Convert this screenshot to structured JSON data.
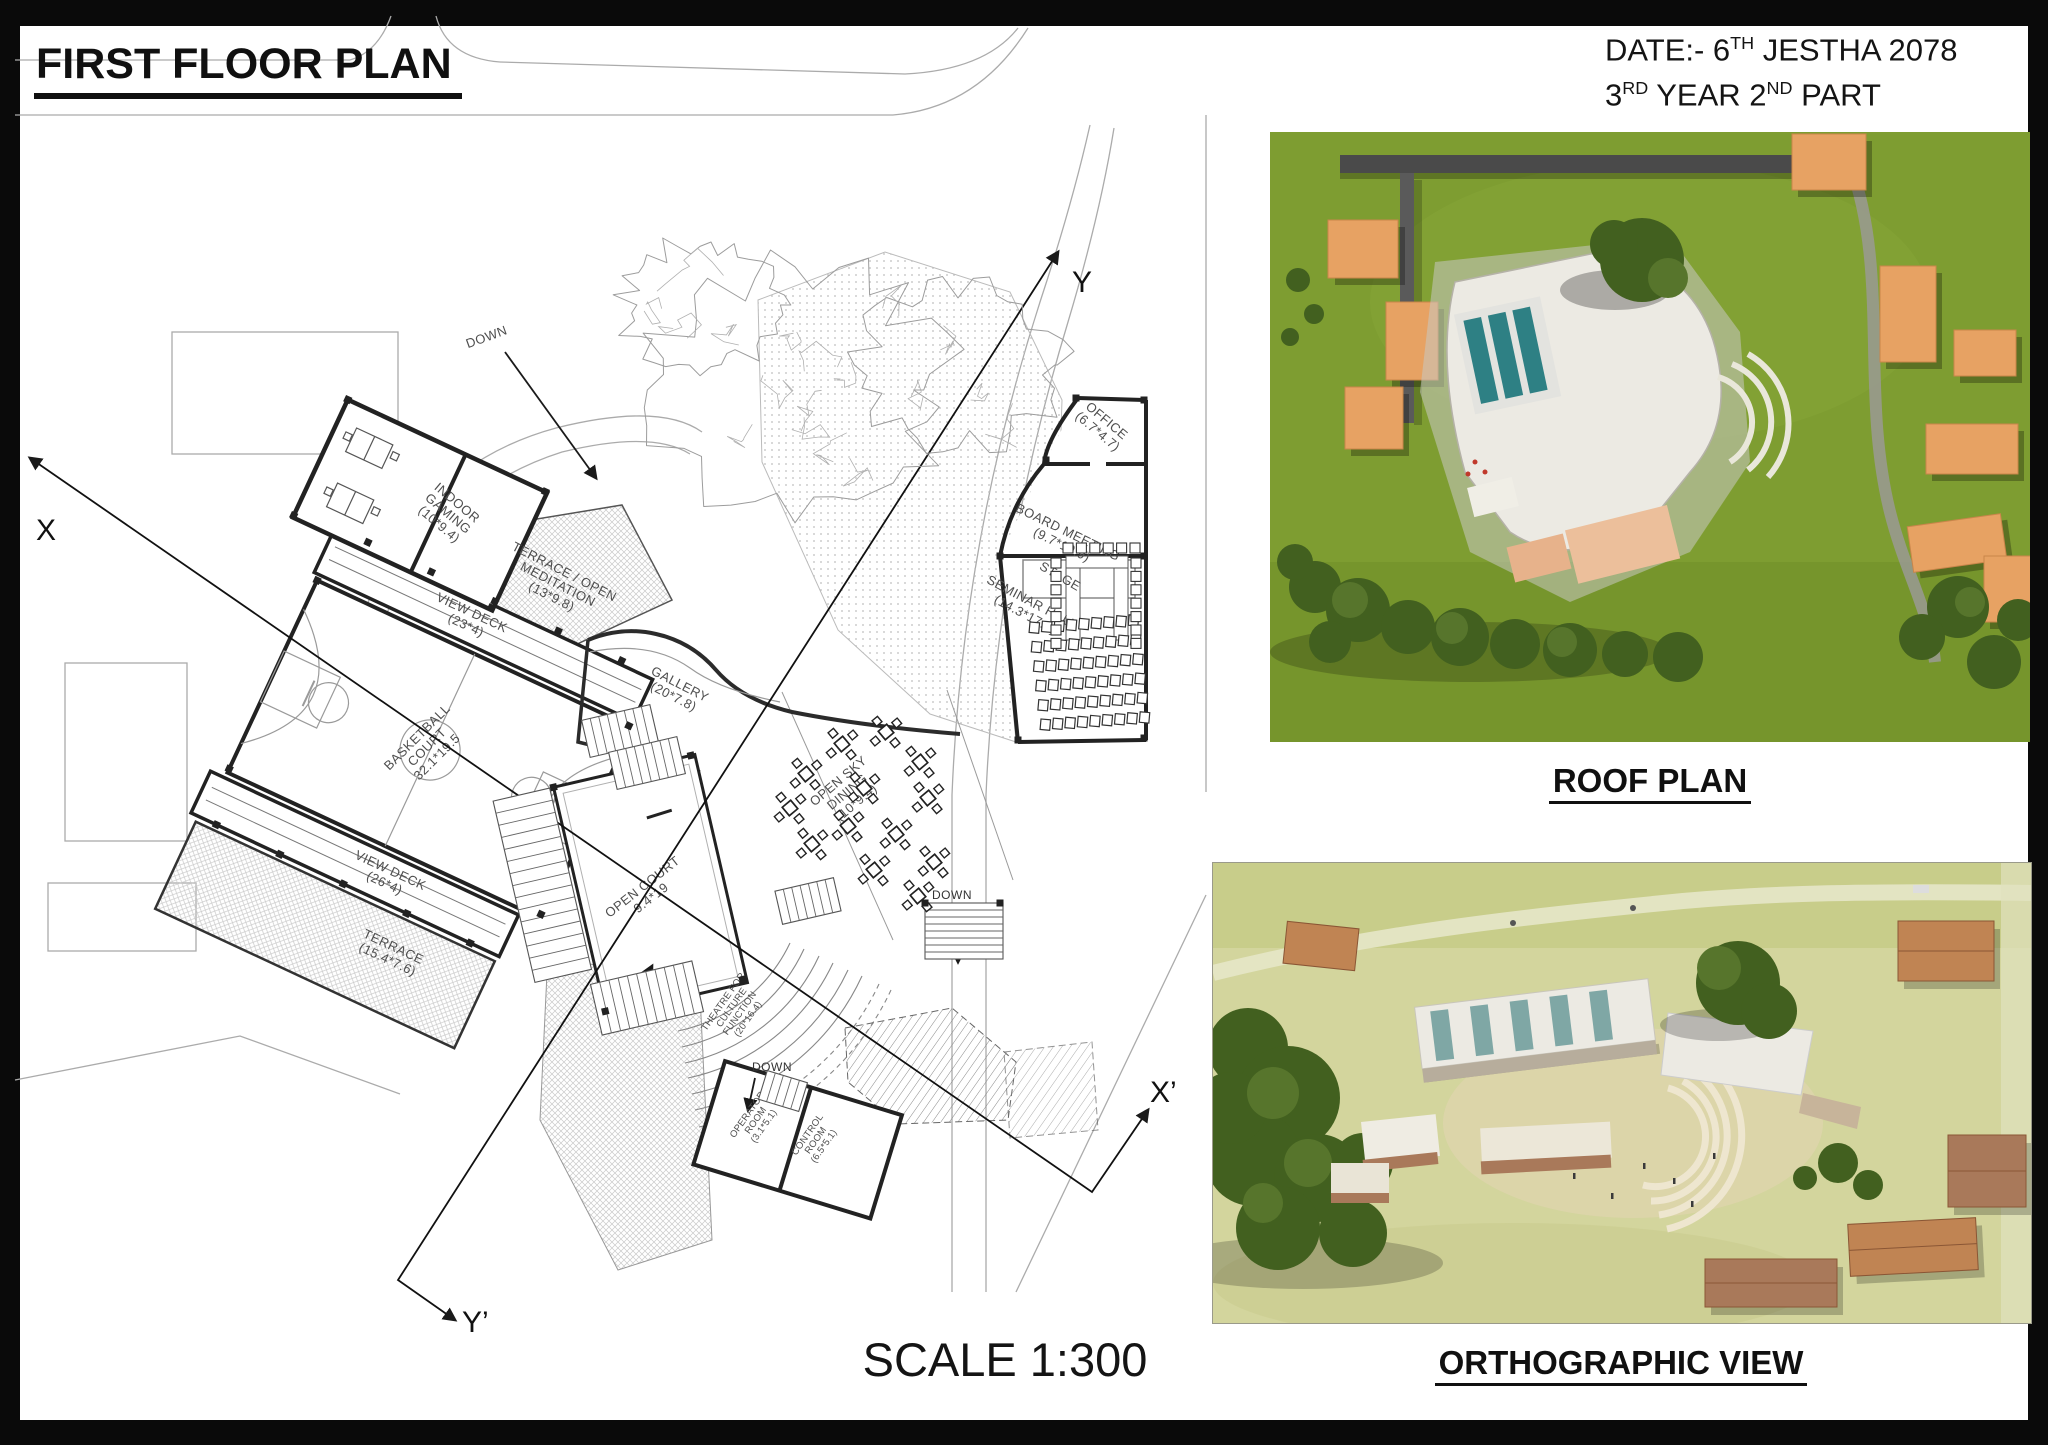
{
  "sheet": {
    "title": "FIRST FLOOR PLAN",
    "scale_label": "SCALE 1:300",
    "date": {
      "l1_a": "DATE:- 6",
      "l1_sup": "TH",
      "l1_b": " JESTHA 2078",
      "l2_a": "3",
      "l2_sup": "RD",
      "l2_b": " YEAR 2",
      "l2_sup2": "ND",
      "l2_c": " PART"
    }
  },
  "renders": {
    "roof_caption": "ROOF PLAN",
    "ortho_caption": "ORTHOGRAPHIC VIEW"
  },
  "sections": {
    "x": "X",
    "x_prime": "X’",
    "y": "Y",
    "y_prime": "Y’"
  },
  "plan": {
    "labels": {
      "ramp_down": "DOWN",
      "indoor_gaming": [
        "INDOOR",
        "GAMING",
        "(10*9.4)"
      ],
      "terrace_meditation": [
        "TERRACE / OPEN",
        "MEDITATION",
        "(13*9.8)"
      ],
      "view_deck_top": [
        "VIEW DECK",
        "(23*4)"
      ],
      "basketball": [
        "BASKETBALL",
        "COURT",
        "32.1*19.5"
      ],
      "gallery": [
        "GALLERY",
        "(20*7.8)"
      ],
      "open_court": [
        "OPEN COURT",
        "9.4*19"
      ],
      "open_sky_dining": [
        "OPEN SKY",
        "DINING",
        "(10*9.4)"
      ],
      "view_deck_bottom": [
        "VIEW DECK",
        "(26*4)"
      ],
      "terrace": [
        "TERRACE",
        "(15.4*7.6)"
      ],
      "office": [
        "OFFICE",
        "(6.7*4.7)"
      ],
      "board_meeting": [
        "BOARD MEETING",
        "(9.7*10.9)"
      ],
      "stage": "STAGE",
      "seminar_hall": [
        "SEMINAR HALL",
        "(14.3*17.9)"
      ],
      "theatre": [
        "THEATRE FOR",
        "CULTURE",
        "FUNCTION",
        "(20*16.4)"
      ],
      "operator_room": [
        "OPERATOR",
        "ROOM",
        "(3.1*5.1)"
      ],
      "control_room": [
        "CONTROL",
        "ROOM",
        "(6.5*5.1)"
      ],
      "up": "UP",
      "down": "DOWN"
    },
    "seminar_chairs": {
      "rows": 6,
      "cols": 9
    },
    "dining_table_count": 13
  },
  "colors": {
    "grass": "#7e9d31",
    "tree": "#42601f",
    "tree_light": "#57752c",
    "orange": "#e7a263",
    "orange_edge": "#c9854a",
    "roof_white": "#eceae3",
    "pool": "#2e8084",
    "ground": "#d3d59d",
    "brick": "#a9795a",
    "path_gray": "#9a9a94"
  }
}
